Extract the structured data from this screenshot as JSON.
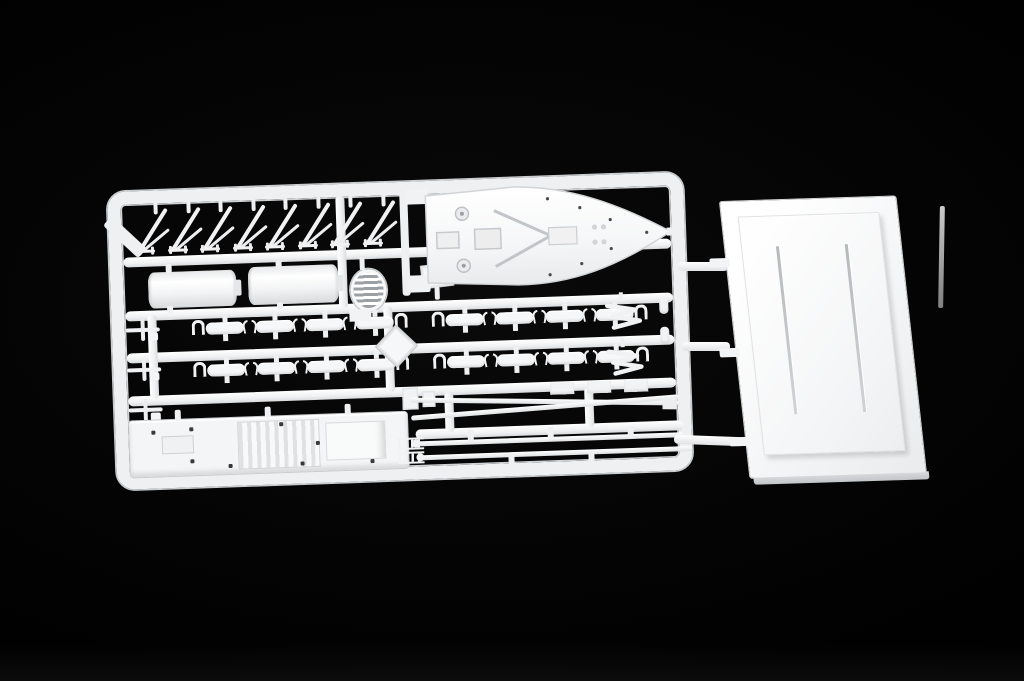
{
  "scene": {
    "description": "Overhead photograph of a white injection-molded polystyrene sprue of ship model parts beside a separate white display base, on a black background",
    "background_color": "#000000",
    "plastic_color": "#f2f3f4",
    "shadow_color": "#c7c9cc"
  },
  "sprue": {
    "label": "ship model parts sprue",
    "davits": {
      "label": "lifeboat davit",
      "count": 8
    },
    "funnels": {
      "label": "funnel half",
      "count": 2
    },
    "vent_grille": {
      "label": "oval vent grille",
      "count": 1
    },
    "lifeboats": {
      "label": "lifeboat",
      "rows": 2,
      "groups_per_row": 2,
      "boats_per_group": 4,
      "total": 16
    },
    "davit_clips_per_group": 3,
    "brackets": {
      "label": "folded crane bracket",
      "count": 2
    },
    "bollards": {
      "label": "bollard fitting",
      "count": 2
    },
    "left_fittings": {
      "label": "small deck fitting",
      "count": 3
    },
    "right_fittings": {
      "label": "hatch fitting",
      "count": 3
    },
    "masts": {
      "label": "mast spar",
      "count": 2
    },
    "spreaders": {
      "label": "curved yard spar",
      "count": 2
    },
    "bow_deck": {
      "label": "forecastle bow deck piece"
    },
    "main_deck": {
      "label": "superstructure deck piece"
    }
  },
  "base": {
    "label": "display base",
    "slots": 2,
    "left_tabs": 3
  },
  "runners": {
    "label": "sprue-to-base runner",
    "count": 3
  }
}
